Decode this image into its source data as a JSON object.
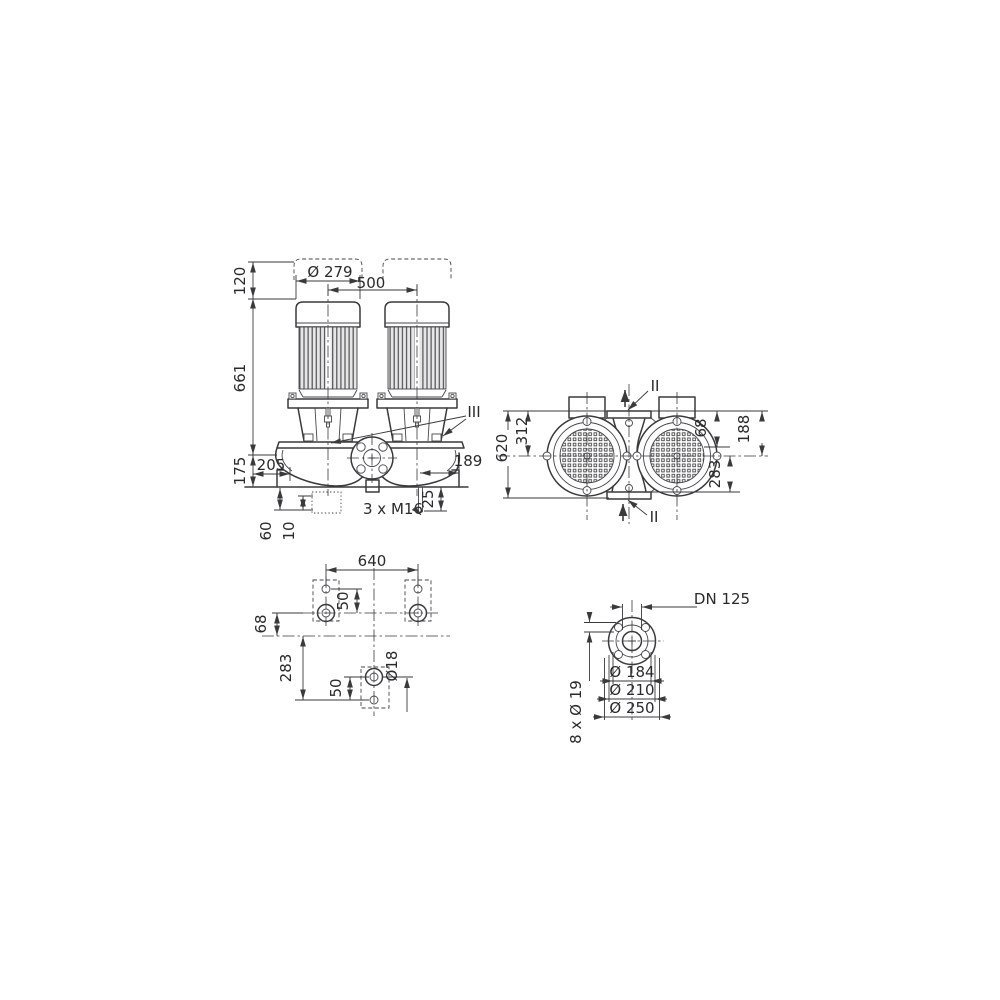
{
  "drawing_type": "pump dimensional drawing",
  "colors": {
    "line": "#3a3a3c",
    "text": "#2a2a2c",
    "background": "#ffffff",
    "fin_shade": "#e6e6e6"
  },
  "front": {
    "d120": "120",
    "d661": "661",
    "d175": "175",
    "dia279": "Ø 279",
    "d500": "500",
    "d205": "205",
    "d189": "189",
    "d25": "25",
    "d60": "60",
    "d10": "10",
    "m16": "3 x M16",
    "section3": "III"
  },
  "end": {
    "d620": "620",
    "d312": "312",
    "d68": "68",
    "d188": "188",
    "d283": "283",
    "section2_top": "II",
    "section2_bottom": "II"
  },
  "plan": {
    "d640": "640",
    "d50_top": "50",
    "d68": "68",
    "d283": "283",
    "d50_bottom": "50",
    "dia18": "Ø18"
  },
  "flange": {
    "dn": "DN 125",
    "dia184": "Ø 184",
    "dia210": "Ø 210",
    "dia250": "Ø 250",
    "bolts": "8 x Ø 19"
  }
}
